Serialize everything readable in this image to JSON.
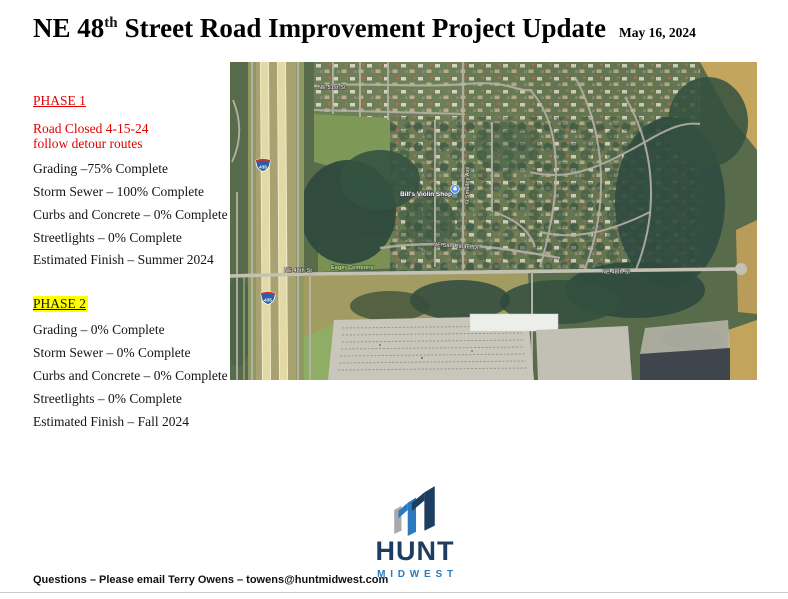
{
  "page": {
    "title_prefix": "NE 48",
    "title_sup": "th",
    "title_rest": "Street Road Improvement Project Update",
    "date": "May 16, 2024"
  },
  "phase1": {
    "heading": "PHASE 1",
    "alert_line1": "Road Closed 4-15-24",
    "alert_line2": "follow detour routes",
    "items": [
      "Grading –75% Complete",
      "Storm Sewer – 100% Complete",
      "Curbs and Concrete – 0% Complete",
      "Streetlights – 0% Complete",
      "Estimated Finish – Summer 2024"
    ]
  },
  "phase2": {
    "heading": "PHASE 2",
    "items": [
      "Grading – 0% Complete",
      "Storm Sewer – 0% Complete",
      "Curbs and Concrete – 0% Complete",
      "Streetlights – 0% Complete",
      "Estimated Finish – Fall 2024"
    ]
  },
  "map": {
    "labels": {
      "ne_51st": "NE 51st St",
      "smalley": "N Smalley Ave",
      "violin_shop": "Bill's Violin Shop",
      "san_rafael": "NE San Rafael Dr",
      "ne_48th_west": "NE 48th St",
      "ne_48th_east": "NE 48th St",
      "cemetery": "Eager Cemetery",
      "route_435": "435"
    }
  },
  "logo": {
    "name": "HUNT",
    "sub": "MIDWEST"
  },
  "footer": {
    "text": "Questions – Please email Terry Owens – towens@huntmidwest.com"
  },
  "colors": {
    "alert_red": "#e00000",
    "highlight_yellow": "#ffff00",
    "brand_navy": "#1d3e5f",
    "brand_blue": "#2b7abd",
    "brand_gray": "#a7a9ac"
  }
}
